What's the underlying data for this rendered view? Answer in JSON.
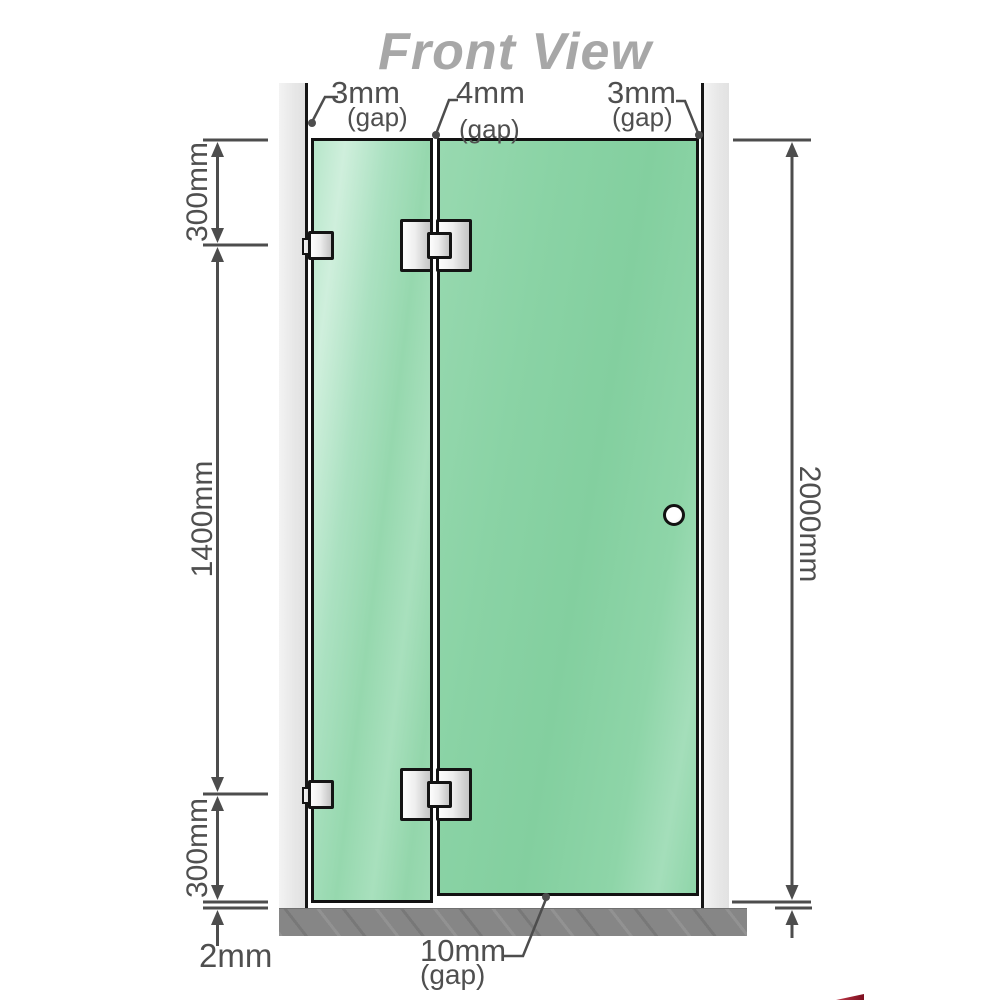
{
  "title": "Front View",
  "top_gaps": {
    "left": {
      "value": "3mm",
      "label": "(gap)"
    },
    "middle": {
      "value": "4mm",
      "label": "(gap)"
    },
    "right": {
      "value": "3mm",
      "label": "(gap)"
    }
  },
  "dimensions": {
    "top_left": "300mm",
    "middle_left": "1400mm",
    "bottom_left": "300mm",
    "floor_gap_left": "2mm",
    "right_height": "2000mm",
    "bottom_gap": {
      "value": "10mm",
      "label": "(gap)"
    }
  },
  "colors": {
    "glass_green": "#8bd3a6",
    "glass_highlight": "#cfefdc",
    "wall_gray": "#e9e9e9",
    "floor_gray": "#868686",
    "dimension_gray": "#4d4d4d",
    "title_gray": "#a7a7a7",
    "hardware_metal": "#e0e0e0",
    "accent_red": "#8b1a2b"
  }
}
